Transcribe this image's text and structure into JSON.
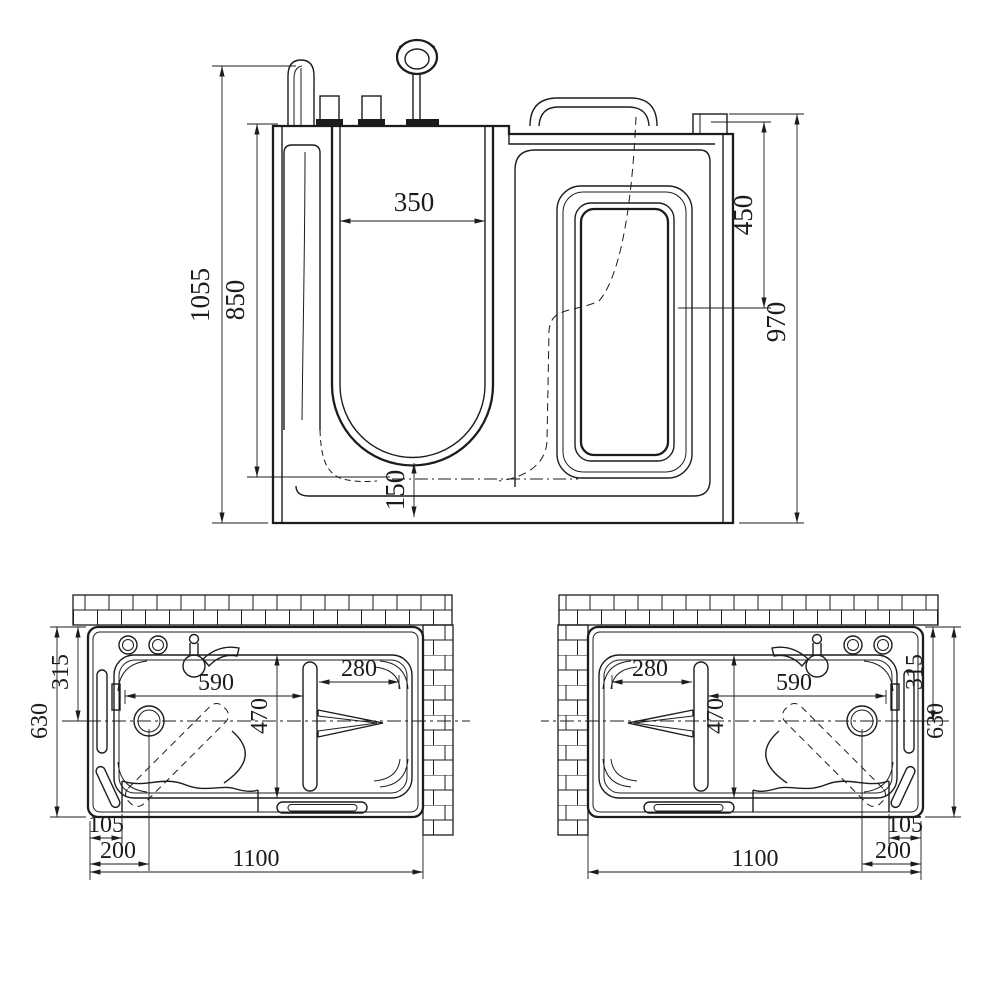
{
  "drawing": {
    "subject": "walk-in-bathtub",
    "line_color": "#1c1c1c",
    "background": "#ffffff"
  },
  "front_view": {
    "dims": {
      "overall_height": "1055",
      "opening_height": "850",
      "opening_width": "350",
      "window_drop": "450",
      "body_height": "970",
      "well_depth": "150"
    }
  },
  "plan_left": {
    "dims": {
      "overall_depth": "630",
      "half_depth": "315",
      "basin_length": "590",
      "basin_width": "470",
      "seat_depth": "280",
      "threshold_offset": "105",
      "drain_offset": "200",
      "overall_length": "1100"
    }
  },
  "plan_right": {
    "dims": {
      "overall_depth": "630",
      "half_depth": "315",
      "basin_length": "590",
      "basin_width": "470",
      "seat_depth": "280",
      "threshold_offset": "105",
      "drain_offset": "200",
      "overall_length": "1100"
    }
  }
}
